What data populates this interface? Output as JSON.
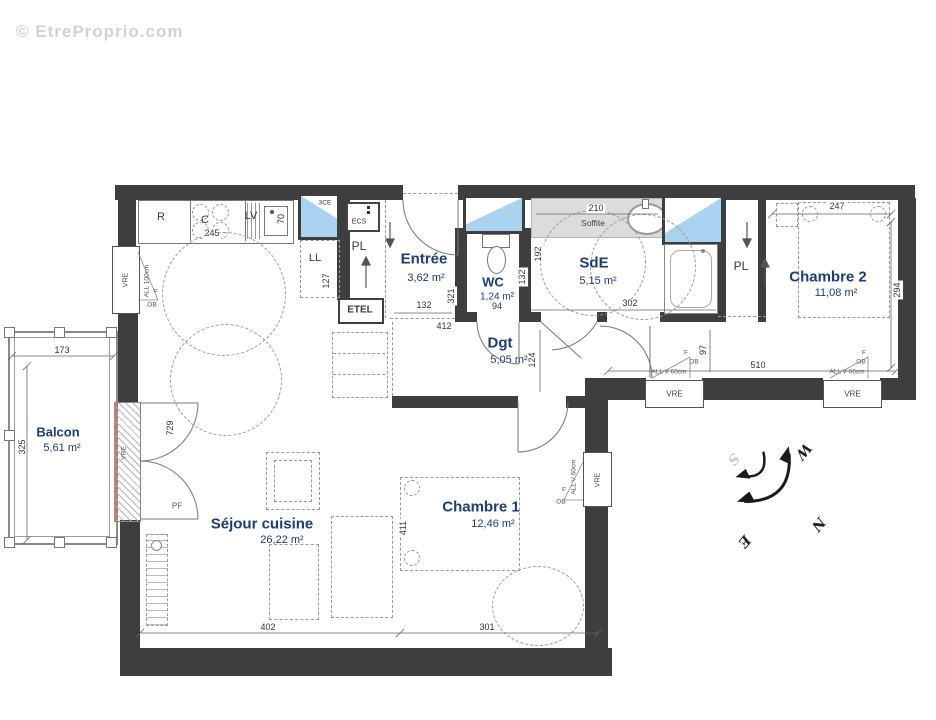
{
  "watermark": "© EtreProprio.com",
  "rooms": {
    "balcon": {
      "name": "Balcon",
      "area": "5,61 m²"
    },
    "sejour": {
      "name": "Séjour cuisine",
      "area": "26,22 m²"
    },
    "entree": {
      "name": "Entrée",
      "area": "3,62 m²"
    },
    "wc": {
      "name": "WC",
      "area": "1,24 m²"
    },
    "sde": {
      "name": "SdE",
      "area": "5,15 m²"
    },
    "dgt": {
      "name": "Dgt",
      "area": "5,05 m²"
    },
    "chambre1": {
      "name": "Chambre 1",
      "area": "12,46 m²"
    },
    "chambre2": {
      "name": "Chambre 2",
      "area": "11,08 m²"
    }
  },
  "equipment": {
    "fridge": "R",
    "cooktop": "C",
    "dishwasher": "LV",
    "flue": "3CE",
    "washer": "LL",
    "water_heater": "ECS",
    "closet": "PL",
    "technical": "ETEL",
    "soffit": "Soffite"
  },
  "openings": {
    "window": "VRE",
    "french_window": "PF",
    "sill_100": "ALL 100cm",
    "sill_60": "ALL V 60cm",
    "fixed": "F",
    "tilt_turn": "OB"
  },
  "dims": {
    "d245": "245",
    "d70": "70",
    "d127": "127",
    "d132": "132",
    "d321": "321",
    "d94": "94",
    "d132b": "132",
    "d192": "192",
    "d210": "210",
    "d302": "302",
    "d412": "412",
    "d124": "124",
    "d97": "97",
    "d510": "510",
    "d247": "247",
    "d294": "294",
    "d173": "173",
    "d325": "325",
    "d729": "729",
    "d411": "411",
    "d402": "402",
    "d301": "301"
  },
  "compass": {
    "n": "N",
    "e": "E",
    "s": "S",
    "w": "W"
  }
}
